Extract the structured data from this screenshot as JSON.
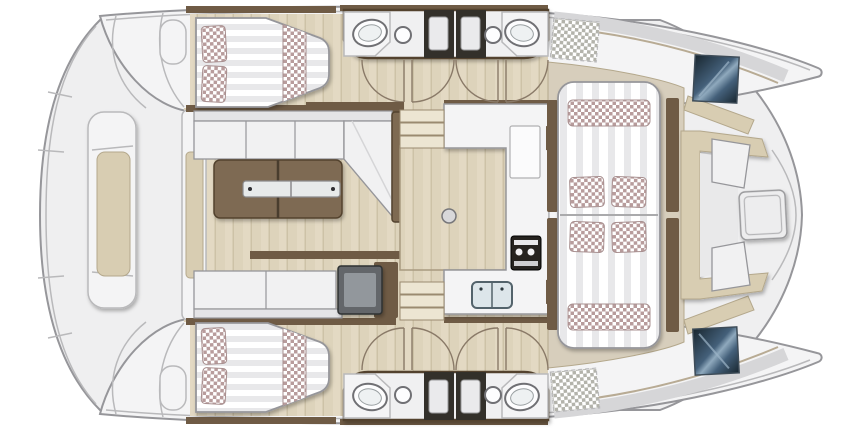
{
  "title": "catamaran-deck-plan",
  "palette": {
    "background": "#ffffff",
    "hull": "#f4f4f5",
    "deck": "#efeff0",
    "outline": "#96969a",
    "line": "#b9b9bb",
    "door": "#8a7a68",
    "wood-a": "#e3d9c3",
    "wood-b": "#ddd3bb",
    "wood-line": "#cdc2a7",
    "tan": "#d7cebc",
    "beige": "#d8cdb2",
    "beige-line": "#b4a88c",
    "brown": "#6f5b45",
    "brown-dark": "#53432f",
    "table-brown": "#7e6a52",
    "cabinet-dark": "#33302a",
    "box-gray": "#63666a",
    "white": "#ffffff",
    "stripe": "#e8e8ea",
    "checker": "#b89c9c",
    "checker-gray": "#b3b3ab",
    "metal": "#e7eaea",
    "sink": "#dde6ea",
    "sink-edge": "#53636b",
    "navy-1": "#18262f",
    "navy-2": "#44607a",
    "navy-3": "#8fa9bd",
    "appliance": "#26231f"
  },
  "plan": {
    "type": "catamaran-floor-plan",
    "view": "top-down",
    "hulls": 2,
    "cabins": [
      {
        "id": "port-aft-cabin",
        "bed": "double",
        "pillows": 2,
        "runner": "checkered"
      },
      {
        "id": "starboard-aft-cabin",
        "bed": "double",
        "pillows": 2,
        "runner": "checkered"
      }
    ],
    "bathrooms": [
      {
        "id": "port-heads",
        "washbasins": 2,
        "shower-columns": 2,
        "doors": 4
      },
      {
        "id": "starboard-heads",
        "washbasins": 2,
        "shower-columns": 2,
        "doors": 4
      }
    ],
    "salon": {
      "sofa": "L-shaped",
      "sofa-seats": 3,
      "coffee-table-sections": 2,
      "bench-seats": 2,
      "appliance-box": 1
    },
    "galley": {
      "island": 1,
      "double-sink": 1,
      "cooktop": 1,
      "companionway-stairs": 2
    },
    "foredeck": {
      "sunpad-sections": 2,
      "sunpad-pillows": 4,
      "bolsters": 2,
      "cocktail-table": 1,
      "bow-hatches": 2,
      "side-tables": 4
    },
    "aft-deck": {
      "bench": 1,
      "bench-cushion": "beige",
      "transom-pads": 2
    }
  }
}
